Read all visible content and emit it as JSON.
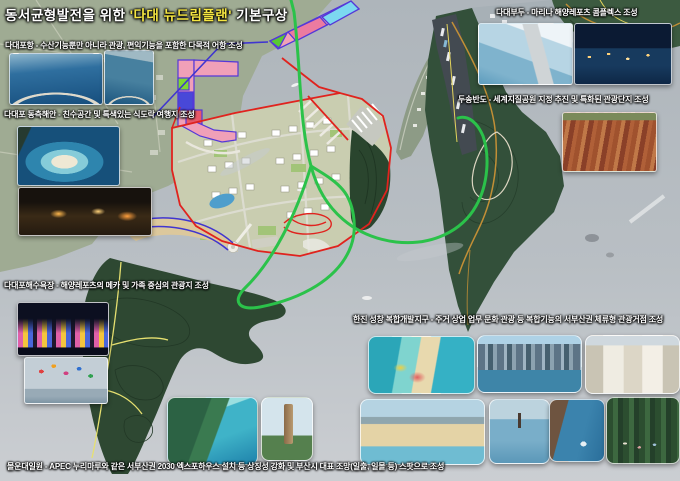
{
  "title": {
    "prefix": "동서균형발전을 위한 ",
    "highlight": "'다대 뉴드림플랜'",
    "suffix": " 기본구상"
  },
  "annotations": {
    "dadaepo_port": "다대포항 - 수산기능뿐만 아니라 관광, 편익기능을 포함한 다목적 어항 조성",
    "east_coast": "다대포 동측해안 - 친수공간 및 특색있는 식도락 여행지 조성",
    "beach": "다대포해수욕장 - 해양레포츠의 메카 및 가족 중심의 관광지 조성",
    "dadae_wharf": "다대부두 - 마리나 해양레포츠 콤플렉스 조성",
    "dusong_peninsula": "두송반도 - 세계지질공원 지정 추진 및 특화된 관광단지 조성",
    "hanjin_seongchang": "한진 성창 복합개발지구 - 주거 상업 업무 문화 관광 등 복합기능의 서부산권 체류형 관광거점 조성",
    "molundae": "몰운대일원 - APEC 누리마루와 같은 서부산권 2030 엑스포하우스 설치 등 상징성 강화 및 부산시 대표 조망(일출, 일몰 등) 스팟으로 조성"
  },
  "photos": [
    {
      "name": "photo-dadaepo-harbor-aerial",
      "desc": "aerial-fishing-harbor-breakwater"
    },
    {
      "name": "photo-harbor-vertical-aerial",
      "desc": "aerial-harbor-pier"
    },
    {
      "name": "photo-east-coast-cove",
      "desc": "aerial-blue-cove-beach"
    },
    {
      "name": "photo-night-food-street",
      "desc": "night-food-street"
    },
    {
      "name": "photo-sunset-fountain",
      "desc": "night-color-fountain-show"
    },
    {
      "name": "photo-kite-surfing",
      "desc": "kites-over-sea"
    },
    {
      "name": "photo-molundae-headland",
      "desc": "aerial-forest-headland"
    },
    {
      "name": "photo-observation-tower",
      "desc": "wooden-observation-tower"
    },
    {
      "name": "photo-marina-complex-render",
      "desc": "marina-complex-rendering"
    },
    {
      "name": "photo-marina-night",
      "desc": "marina-at-night"
    },
    {
      "name": "photo-geopark-cliff",
      "desc": "red-rock-cliff-strata"
    },
    {
      "name": "photo-resort-waterpark",
      "desc": "aerial-resort-waterpark"
    },
    {
      "name": "photo-marina-skyline",
      "desc": "city-marina-skyline"
    },
    {
      "name": "photo-shopping-street",
      "desc": "european-shopping-street"
    },
    {
      "name": "photo-urban-beach",
      "desc": "urban-lagoon-beach"
    },
    {
      "name": "photo-paddle-boarding",
      "desc": "stand-up-paddle-boarding"
    },
    {
      "name": "photo-cliff-diving",
      "desc": "cliff-diving"
    },
    {
      "name": "photo-forest-yoga",
      "desc": "forest-yoga-class"
    }
  ],
  "colors": {
    "highlight_yellow": "#f5e642",
    "boundary_red": "#e0231e",
    "route_green": "#2bc24a",
    "line_blue": "#4035d0",
    "sea_gray": "#b9bfc5"
  }
}
